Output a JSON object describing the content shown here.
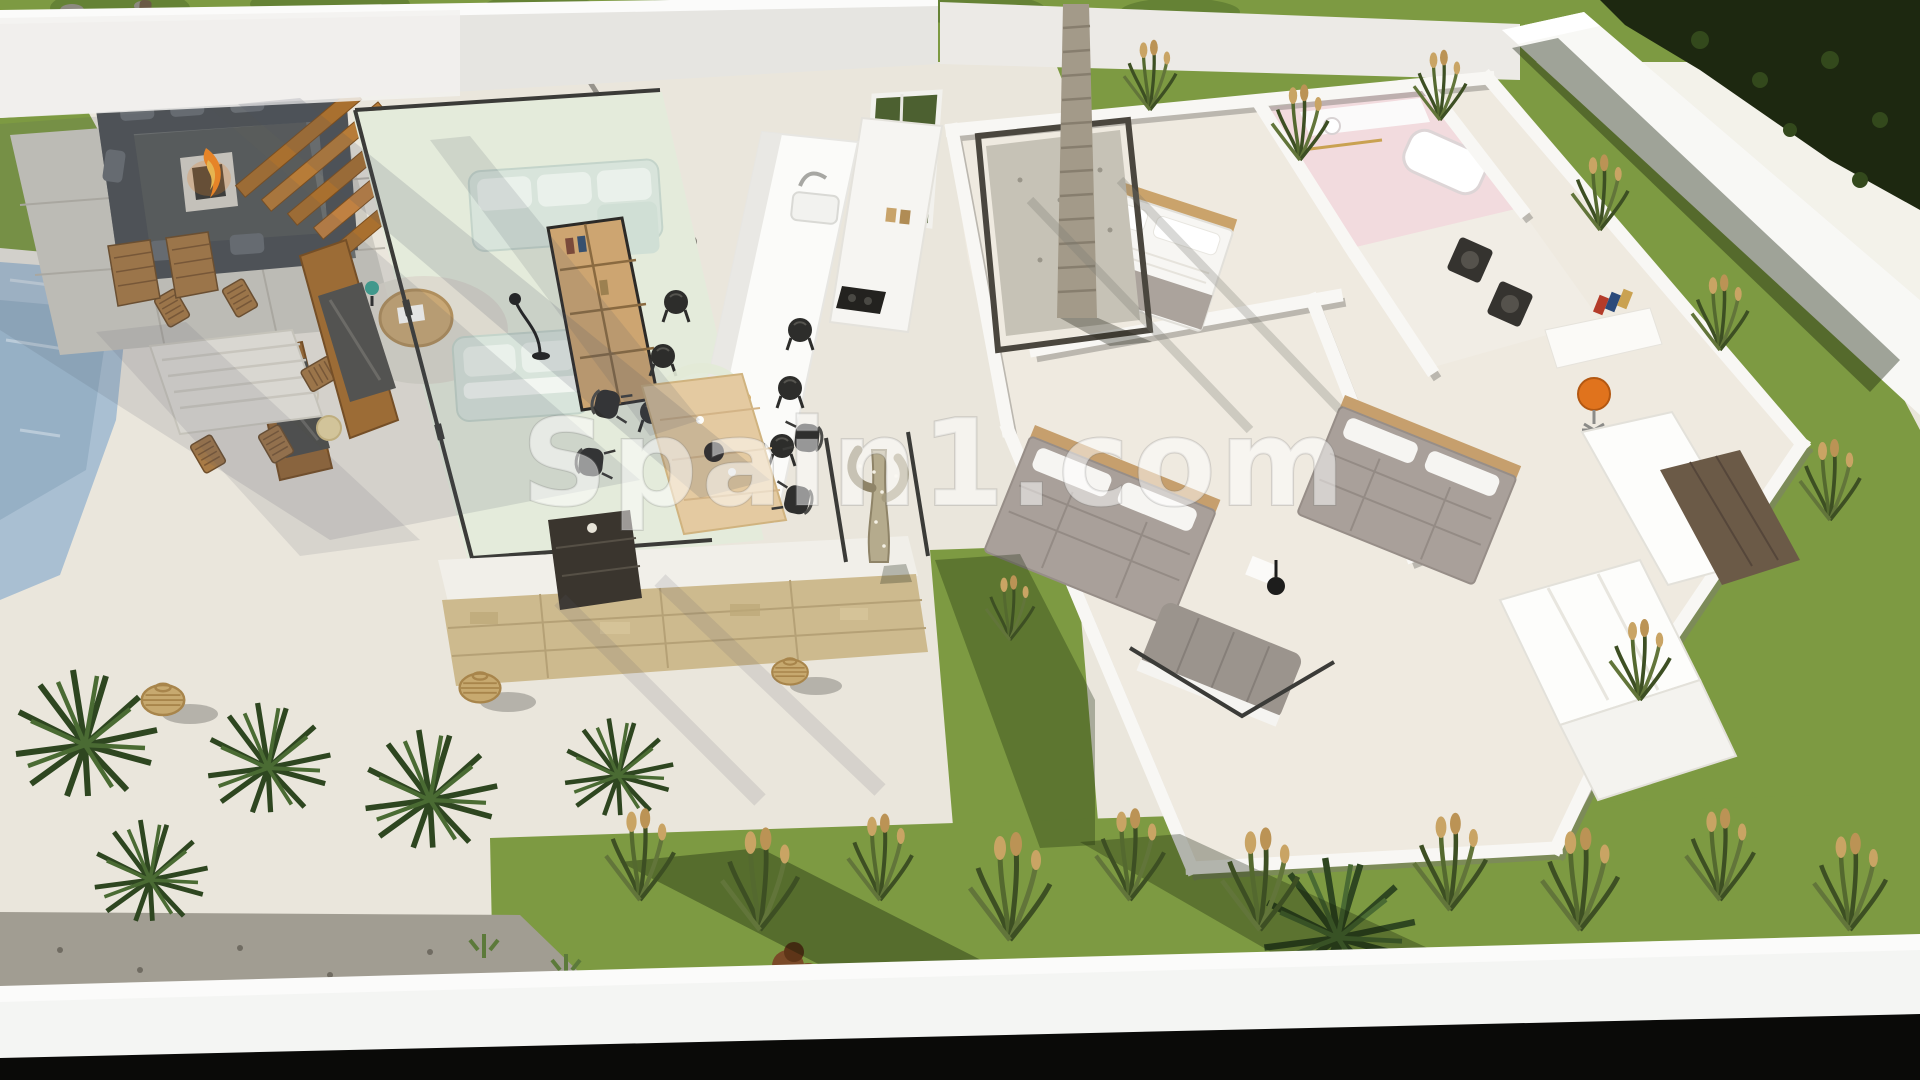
{
  "watermark": {
    "text": "Spain1.com"
  },
  "palette": {
    "canvas": "#eae6dc",
    "terrace_sun": "#f4f0e6",
    "grass": "#7d9a42",
    "grass_shade": "#5d7a31",
    "foliage_dark": "#1d2810",
    "wall_face": "#e6e5e1",
    "wall_bright": "#f8f8f5",
    "overexposed": "#f3f2ea",
    "pool": "#a9bfd2",
    "wood": "#a9702f",
    "charcoal_sofa": "#4e5256",
    "fire": "#ff8c1f",
    "fire_core": "#ffc54d",
    "stone_tile": "#cfccc3",
    "mint_floor": "#e4ebdb",
    "mint_sofa": "#d8e4db",
    "bookshelf_wood": "#cda571",
    "island_white": "#fbfbf9",
    "stool_black": "#2d2d2b",
    "dining_wood": "#e4caa1",
    "chair_black": "#2f2f2e",
    "stone_wall": "#cdba8e",
    "cactus": "#b5ab8d",
    "palm_trunk": "#a39a89",
    "courtyard_gravel": "#c6c2b6",
    "bed_white": "#f7f6f3",
    "bed_gray": "#a9a09a",
    "pink_room": "#f2dbde",
    "orange_chair": "#e0731d",
    "lantern": "#c7a96f",
    "wing_floor": "#efeae0",
    "bottom_wall": "#f4f5f3",
    "black_strip": "#0a0a08",
    "watermark": "rgba(255,255,255,0.5)"
  },
  "objects": [
    "perimeter-wall",
    "garden-grass",
    "sunken-lounge-with-fire-pit",
    "wood-slat-screen",
    "swimming-pool",
    "outdoor-dining-set",
    "outdoor-tv-panel",
    "living-room-sofas",
    "bookshelf",
    "coffee-table",
    "kitchen-island",
    "bar-stools",
    "indoor-dining-table",
    "ring-lamp",
    "stone-feature-wall",
    "entry-console",
    "cactus",
    "palm-courtyard",
    "master-bedroom-bed",
    "bedroom-2-bed",
    "bedroom-3-bed",
    "pink-bathroom",
    "laundry-appliances",
    "desk-with-orange-chair",
    "wardrobe",
    "rattan-lanterns",
    "palm-bushes",
    "ornamental-grasses"
  ]
}
